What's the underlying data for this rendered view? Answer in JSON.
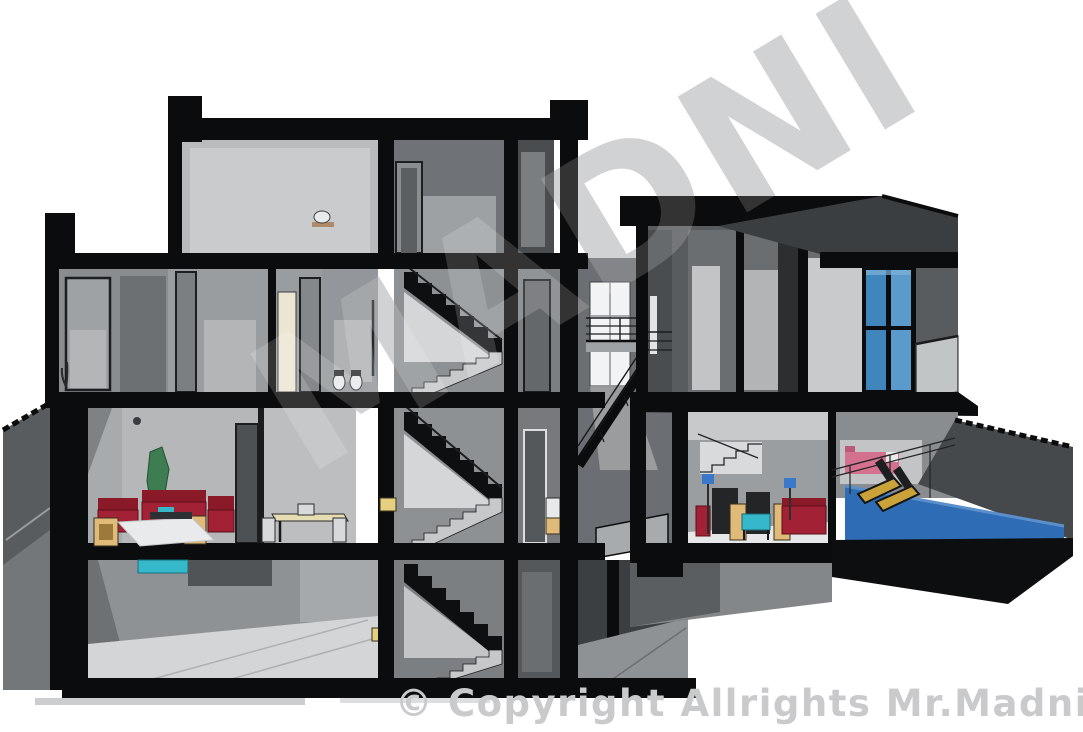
{
  "watermarks": {
    "diagonal_text": "MADNI",
    "copyright_text": "© Copyright Allrights Mr.Madni",
    "watermark_gray": "#c8cacc"
  },
  "palette": {
    "cut_black": "#0b0c0d",
    "wall_dark": "#55585b",
    "wall_mid": "#93969a",
    "wall_light": "#c6c8ca",
    "floor_light": "#e3e4e6",
    "glass_blue": "#3e86bc",
    "glass_blue_light": "#5b9bcb",
    "pool_blue": "#2e6cb5",
    "accent_cyan": "#35b8c9",
    "sofa_red": "#a32134",
    "sofa_red_dark": "#8a1a28",
    "wood_tan": "#dfba79",
    "plant_green": "#3e7c52",
    "bed_pink": "#d4718f",
    "lamp_yellow": "#e6cf7e",
    "lamp_blue": "#3a78c9",
    "lounge_tan": "#caa23a"
  }
}
